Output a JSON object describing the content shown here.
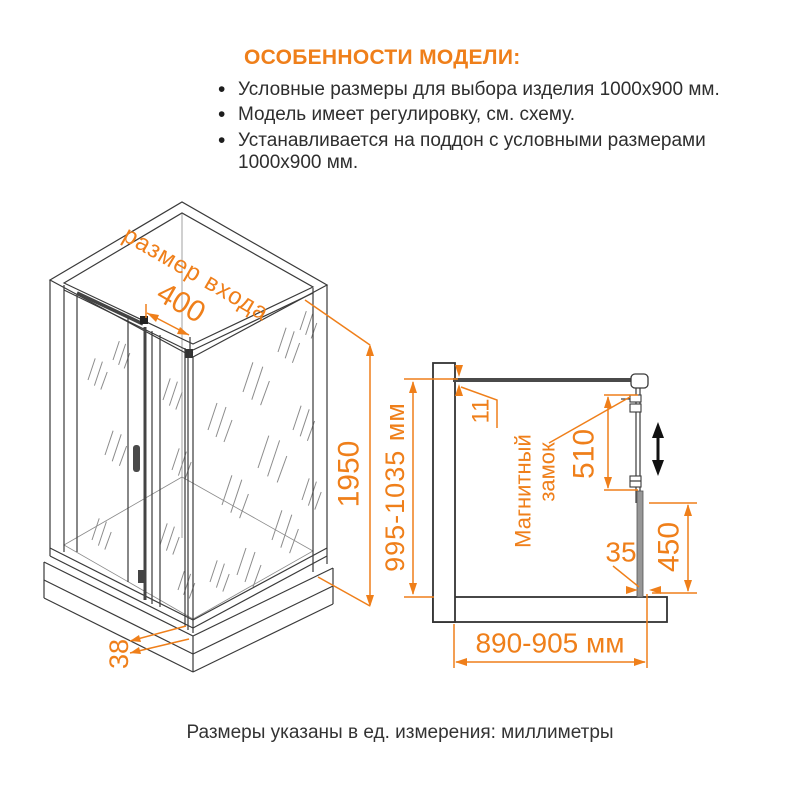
{
  "features": {
    "title": "ОСОБЕННОСТИ МОДЕЛИ:",
    "items": [
      "Условные размеры для выбора изделия 1000x900 мм.",
      "Модель имеет регулировку, см. схему.",
      "Устанавливается на поддон с условными размерами 1000x900 мм."
    ]
  },
  "iso_view": {
    "entry_label": "размер входа",
    "entry_width": "400",
    "height": "1950",
    "tray_height": "38"
  },
  "plan_view": {
    "door_overlap": "11",
    "magnet_lock": {
      "line1": "Магнитный",
      "line2": "замок"
    },
    "lock_length": "510",
    "profile_gap": "35",
    "side_lower_height": "450",
    "height_range": "995-1035 мм",
    "width_range": "890-905 мм"
  },
  "footnote": "Размеры указаны в ед. измерения: миллиметры",
  "colors": {
    "accent": "#EF7F1A",
    "line": "#3A3A3A"
  }
}
